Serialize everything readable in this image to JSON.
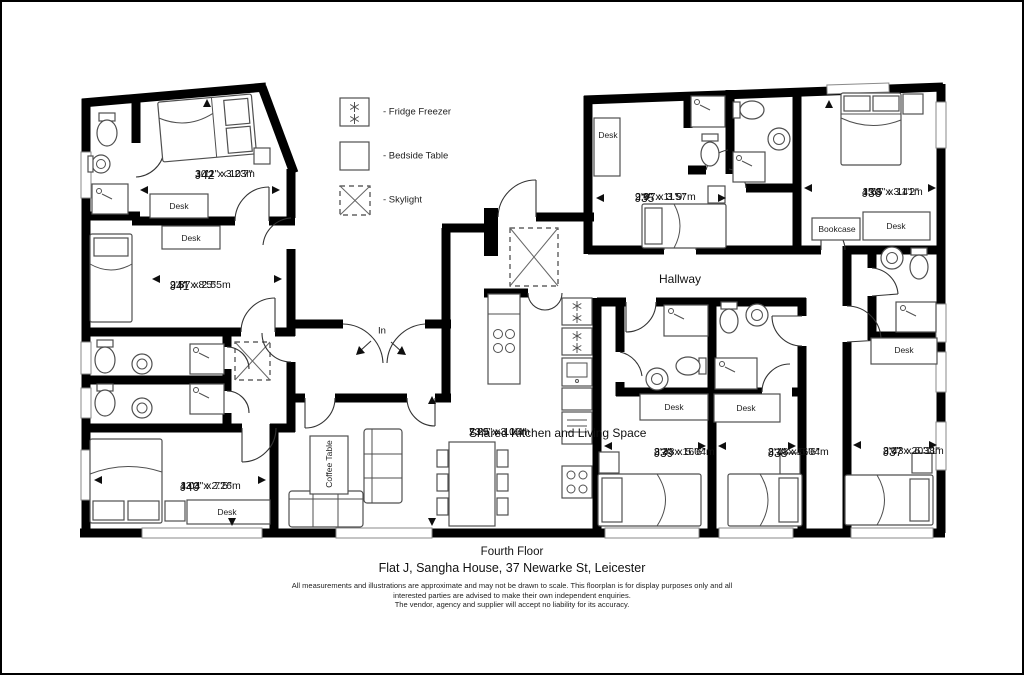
{
  "colors": {
    "wall": "#000000",
    "furn": "#4f4f4f",
    "door": "#333333",
    "bg": "#ffffff"
  },
  "legend": {
    "items": [
      {
        "symbol": "fridge-freezer-symbol",
        "label": "- Fridge Freezer"
      },
      {
        "symbol": "bedside-table-symbol",
        "label": "- Bedside Table"
      },
      {
        "symbol": "skylight-symbol",
        "label": "- Skylight"
      }
    ]
  },
  "rooms": [
    {
      "id": "j42",
      "name": "J42",
      "metric": "3.11 x 3.23m",
      "imperial": "10'2\" x 10'7\"",
      "cx": 193,
      "cy": 166
    },
    {
      "id": "j41",
      "name": "J41",
      "metric": "2.87 x 2.55m",
      "imperial": "9'5\" x 8'5\"",
      "cx": 168,
      "cy": 277
    },
    {
      "id": "j40",
      "name": "J40",
      "metric": "4.04 x 2.26m",
      "imperial": "13'3\" x 7'5\"",
      "cx": 178,
      "cy": 478
    },
    {
      "id": "j35",
      "name": "J35",
      "metric": "2.97 x 3.57m",
      "imperial": "9'9\" x 11'9\"",
      "cx": 633,
      "cy": 189
    },
    {
      "id": "j36",
      "name": "J36",
      "metric": "4.65 x 3.41m",
      "imperial": "15'3\" x 11'2\"",
      "cx": 860,
      "cy": 184
    },
    {
      "id": "j39",
      "name": "J39",
      "metric": "2.48 x 5.04m",
      "imperial": "8'2\" x 16'6\"",
      "cx": 652,
      "cy": 444
    },
    {
      "id": "j38",
      "name": "J38",
      "metric": "2.48 x 5.04m",
      "imperial": "8'1\" x 16'6\"",
      "cx": 766,
      "cy": 444
    },
    {
      "id": "j37",
      "name": "J37",
      "metric": "2.43 x 6.38m",
      "imperial": "8'0\" x 20'11\"",
      "cx": 881,
      "cy": 443
    },
    {
      "id": "shared-kitchen",
      "name": "Shared Kitchen and Living Space",
      "metric": "7.25 x 3.16m",
      "imperial": "23'9\" x 10'4\"",
      "cx": 467,
      "cy": 424
    }
  ],
  "furniture_labels": [
    {
      "text": "Desk",
      "x": 177,
      "y": 204,
      "rot": 0
    },
    {
      "text": "Desk",
      "x": 189,
      "y": 236,
      "rot": 0
    },
    {
      "text": "Desk",
      "x": 225,
      "y": 510,
      "rot": 0
    },
    {
      "text": "Desk",
      "x": 606,
      "y": 133,
      "rot": 0
    },
    {
      "text": "Bookcase",
      "x": 835,
      "y": 227,
      "rot": 0
    },
    {
      "text": "Desk",
      "x": 894,
      "y": 224,
      "rot": 0
    },
    {
      "text": "Desk",
      "x": 672,
      "y": 405,
      "rot": 0
    },
    {
      "text": "Desk",
      "x": 744,
      "y": 406,
      "rot": 0
    },
    {
      "text": "Desk",
      "x": 902,
      "y": 348,
      "rot": 0
    },
    {
      "text": "Coffee Table",
      "x": 327,
      "y": 462,
      "rot": -90
    }
  ],
  "labels": {
    "hallway": "Hallway",
    "in": "In"
  },
  "footer": {
    "floor": "Fourth Floor",
    "address": "Flat J, Sangha House, 37 Newarke St, Leicester",
    "disclaimer1": "All measurements and illustrations are approximate and may not be drawn to scale. This floorplan is for display purposes only and all",
    "disclaimer2": "interested parties are advised to make their own independent enquiries.",
    "disclaimer3": "The vendor, agency and supplier will accept no liability for its accuracy."
  }
}
